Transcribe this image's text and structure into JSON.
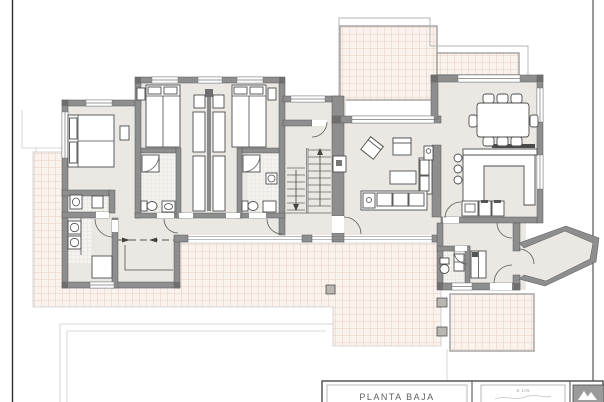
{
  "title_block": {
    "title": "PLANTA BAJA",
    "scale_label": "E: 1/75"
  },
  "icons": {
    "logo": "mountain-logo-icon"
  },
  "colors": {
    "wall": "#8e8e8e",
    "wall_dark": "#6e6e6e",
    "floor": "#ebe8e4",
    "terrace_tile_bg": "#faf2ed",
    "terrace_tile_line": "#e2c1af",
    "bath_tile_bg": "#f5f3f0",
    "bath_tile_line": "#d9d5d0",
    "furniture_line": "#4c4c4c",
    "terrace_border": "#a6a6a6",
    "frame_line": "#2f2f2f",
    "faint_line": "#dadada",
    "logo_bg": "#9b9b9b",
    "title_text": "#5f5f5f"
  }
}
